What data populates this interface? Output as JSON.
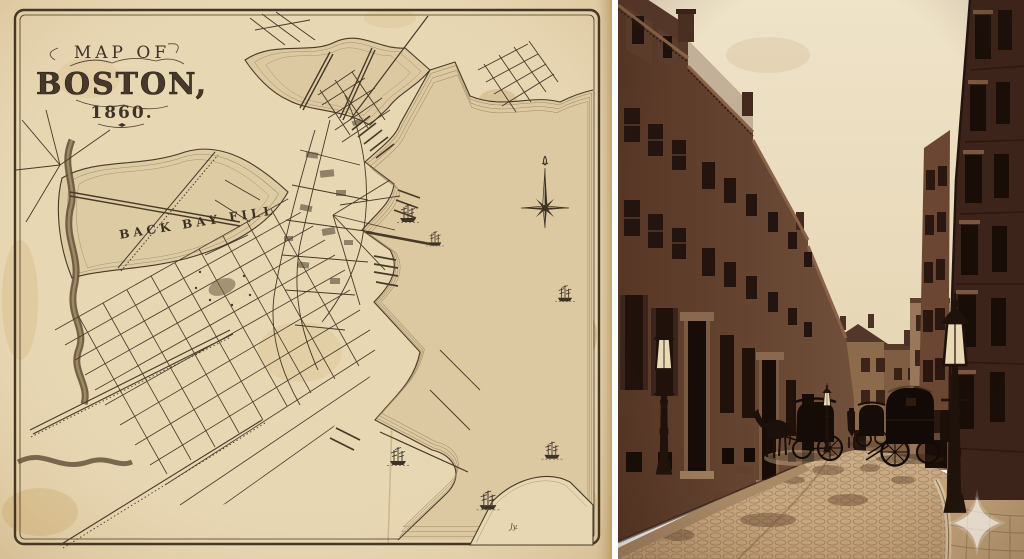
{
  "page": {
    "description": "Antique 1860 map of Boston beside a sepia photograph of a Boston street with horse-drawn carriages"
  },
  "panels": {
    "map": {
      "title_line1": "MAP OF",
      "title_line2": "BOSTON,",
      "title_line3": "1860.",
      "back_bay_label": "BACK BAY FILL",
      "signature": "Jy.",
      "colors": {
        "paper": "#e7d7b3",
        "paper_edge": "#cbab7c",
        "ink": "#473a28",
        "water_shade": "#dcc9a1"
      }
    },
    "photo": {
      "colors": {
        "sky": "#ede1c6",
        "brick_near": "#5e3c2b",
        "brick_dark": "#3c241a",
        "street": "#c2a37b",
        "watermark": "#ffffff"
      }
    }
  }
}
